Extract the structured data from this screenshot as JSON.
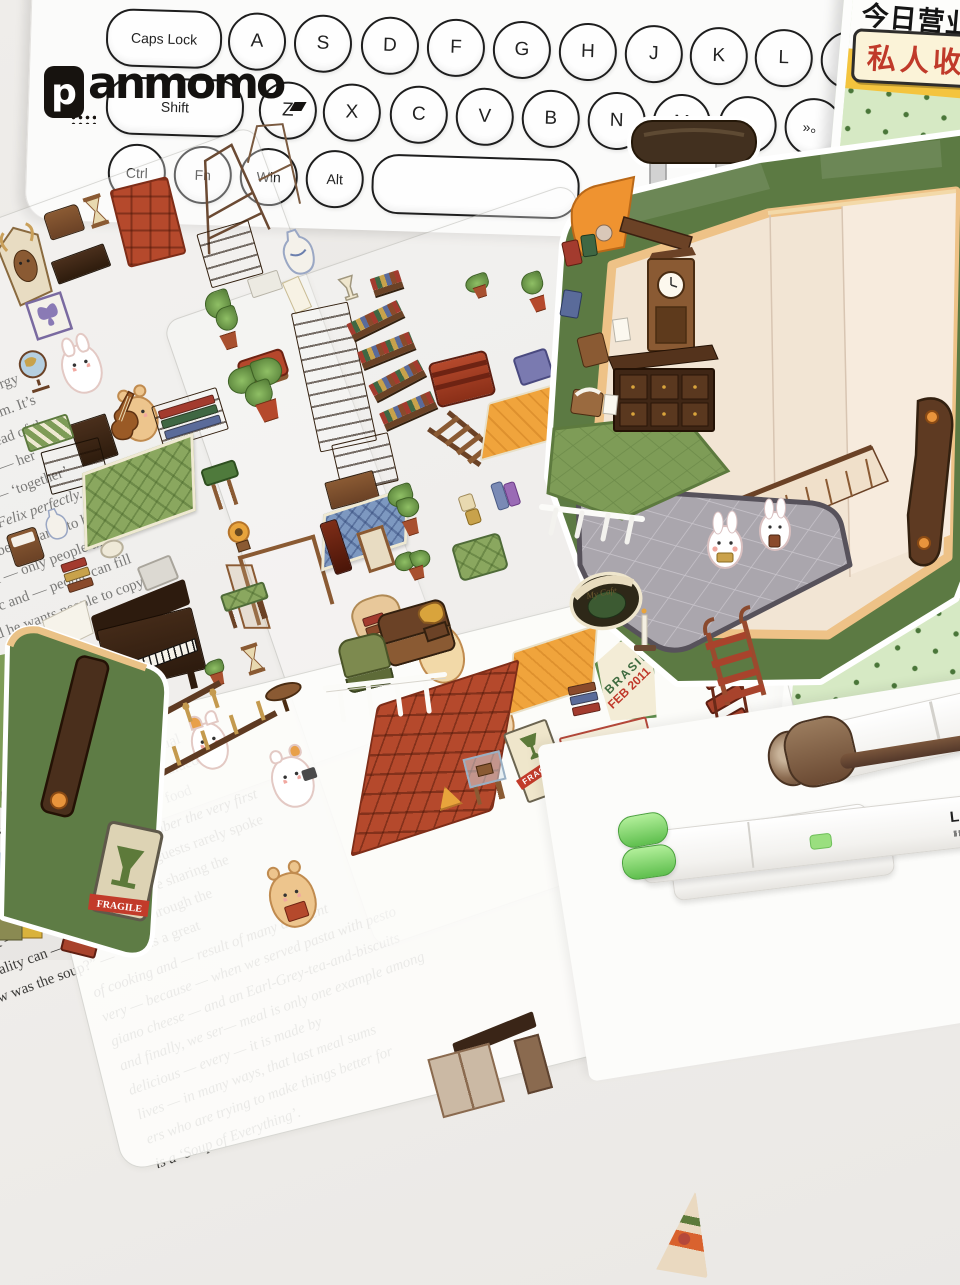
{
  "brand": {
    "box_letter": "p",
    "wordmark": "anmomo"
  },
  "keyboard": {
    "row1": [
      "Caps Lock",
      "A",
      "S",
      "D",
      "F",
      "G",
      "H",
      "J",
      "K",
      "L"
    ],
    "row2": [
      "Shift",
      "Z",
      "X",
      "C",
      "V",
      "B",
      "N",
      "M",
      "«‹",
      "»。"
    ],
    "row3": [
      "Ctrl",
      "Fn",
      "Win",
      "Alt"
    ]
  },
  "package": {
    "title_top": "O S",
    "title": "STICKER",
    "subtitle": "今日营业中第7",
    "label": "私人收藏馆"
  },
  "stamps": {
    "brasil_country": "BRASIL",
    "brasil_date": "FEB 2011",
    "canada_country": "CANADA",
    "canada_date": "29 MAR 2011",
    "canada_code": "D 408",
    "fragile": "FRAGILE",
    "record": "My Cafe"
  },
  "pens": {
    "pen_label": "LIN"
  },
  "newspaper": {
    "colA": [
      "’ve ever met. In her opinion, the energy",
      "the energy of Massimo and our team. It’s",
      "ble happy — ward, who’s also head of the",
      "ed a map of provocative words — her",
      "that last — make the normal — ‘together’",
      "surprisingly, suit Refettorio Felix perfectly. She",
      "opriate ideas. You have to be prepared to be",
      "st go — but if — create a — only people that",
      "n is there. I’m optimistic and — people can fill",
      "g it in a vivid way, and he wants people to copy him."
    ],
    "colB": [
      "was a — 14 ye— and family, adore—",
      "on for others. The re— collects surplus food",
      "kindness and — volun— torio Felix is",
      "f Felix vans, — for the homeless and —",
      "at the table. Bottura puts it like this: “Our guests",
      "uations of food poverty, food insecurity, and social",
      "style service — want to make each guest feel valued",
      "the people — did not have to queue for their food",
      "original Refettorio in Milan. “I still remember the very first",
      "table and eating their meal. A couple of guests rarely spoke",
      "a huge part — volunteers — chefs were sharing the",
      "name — ality can — and inclusion through the",
      "“Hi, how was the soup?” — “It was a great"
    ],
    "colC": [
      "of cooking and — result of many different",
      "very — because — when we served pasta with pesto",
      "giano cheese — and an Earl-Grey-tea-and-biscuits",
      "and finally, we ser— meal is only one example among",
      "delicious — every — it is made by",
      "lives — in many ways, that last meal sums",
      "ers who are trying to make things better for",
      "is a ‘Soup of Everything’."
    ]
  }
}
